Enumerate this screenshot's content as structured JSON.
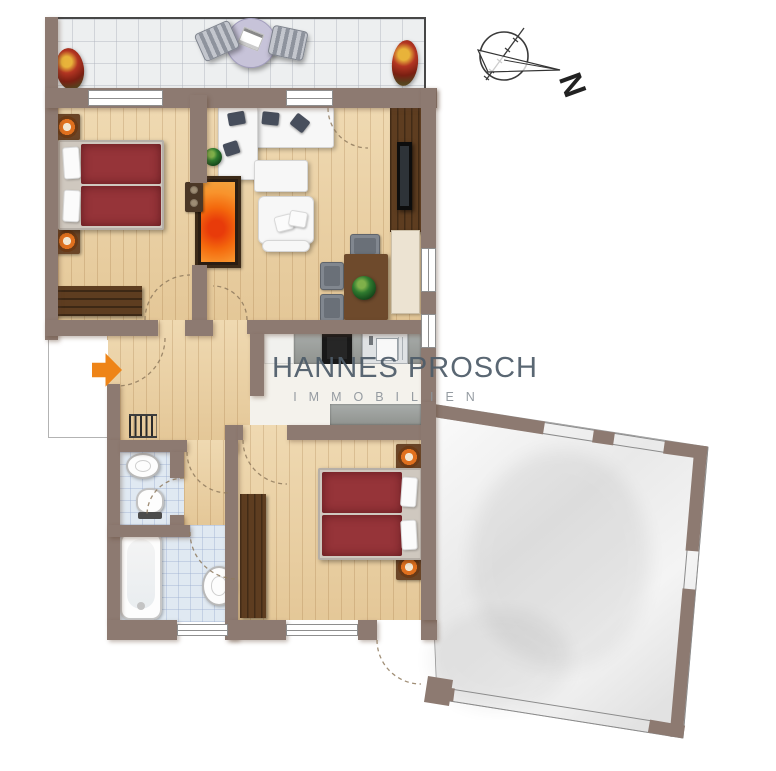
{
  "watermark": {
    "title": "HANNES PROSCH",
    "subtitle": "IMMOBILIEN"
  },
  "compass": {
    "label": "N"
  },
  "colors": {
    "wall": "#8d7a71",
    "wood": "#eacfa0",
    "tile_balcony": "#edeff0",
    "tile_bath": "#e0e9f2",
    "kitchen_floor": "#f4f2ec",
    "bed_red": "#963439",
    "furniture_wood": "#5e3d20",
    "fire_orange": "#f4690d",
    "arrow_orange": "#ee8418",
    "wm_title": "#4e5c69",
    "wm_sub": "#8e959c",
    "dash": "#8f7a5e",
    "glass_line": "#8e8e8e"
  },
  "icons": [
    "flower-pot-icon",
    "sun-lounger-icon",
    "patio-table-icon",
    "compass-rose-icon",
    "double-bed-icon",
    "nightstand-lamp-icon",
    "dresser-icon",
    "wardrobe-icon",
    "corner-sofa-icon",
    "armchair-icon",
    "coffee-table-icon",
    "plant-icon",
    "fireplace-icon",
    "tv-panel-icon",
    "sideboard-icon",
    "dining-table-icon",
    "dining-chair-icon",
    "kitchen-counter-icon",
    "cooktop-icon",
    "kitchen-sink-icon",
    "radiator-icon",
    "washbasin-icon",
    "toilet-icon",
    "bathtub-icon",
    "entrance-arrow-icon",
    "door-swing-icon",
    "window-icon"
  ]
}
